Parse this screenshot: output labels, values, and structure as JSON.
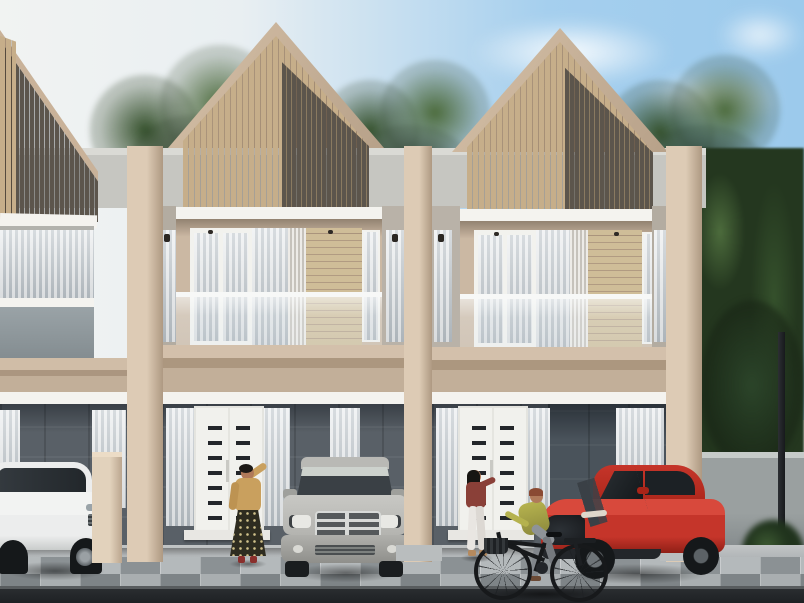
{
  "scene": {
    "type": "architectural-exterior-3d-render",
    "description": "Daytime photorealistic render of a row of modern two-storey minimalist townhouses with gabled facades clad in vertical wood slats (light oak left portion, dark grey-brown right portion), glass-railed balconies with white curtained doors, cream pillars, dark stone ground floors with white slatted entry doors, a checkered paver forecourt, three parked cars, two standing women and a passing cyclist, with dense green trees behind and to the right",
    "weather": "clear day",
    "text_visible": "none"
  },
  "palette": {
    "sky-blue": "#a5cfee",
    "sky-haze": "#f0f3f3",
    "tree-dark": "#24371f",
    "tree-mid": "#35512c",
    "tree-light": "#4c6b3c",
    "wood-light": "#c6ae8a",
    "wood-dark": "#5c554c",
    "plank": "#cfbd98",
    "trim": "#c9b299",
    "fascia-white": "#f4f3ef",
    "wall-cream": "#cbb8a3",
    "wall-cream-light": "#ddcbb5",
    "wall-cream-dark": "#ae9982",
    "parapet-gray": "#c6c6c1",
    "stone-gray": "#596067",
    "stone-dark": "#4a535b",
    "curtain-light": "#e7eaec",
    "curtain-shade": "#b7bfc5",
    "pave-light": "#b4b9bb",
    "pave-mid": "#8b9194",
    "pave-light2": "#a9aeb0",
    "pave-mid2": "#7e8487",
    "road-dark": "#1e2124",
    "boundary-wall": "#9aa0a0",
    "car-white": "#eceded",
    "car-silver": "#b4b4b0",
    "car-red": "#c5352a",
    "car-red-dark": "#8f1f16",
    "stripe-dark": "#3a4046",
    "bike-dark": "#17191b",
    "skin": "#b07a5a",
    "hair-dark": "#1d1a17",
    "outfit-mustard": "#c9a05e",
    "skirt-dark": "#2e2c20",
    "outfit-maroon": "#8a4038",
    "pants-white": "#e9e6e2",
    "outfit-green": "#b5b24e",
    "pants-gray": "#8e9398"
  },
  "buildings": {
    "townhouse_count_fully_visible": 2,
    "neighbor_partial_left": true,
    "storeys": 2,
    "gable": {
      "cladding_left": "light vertical wood slats",
      "cladding_right": "dark grey-brown vertical slats",
      "trim": "cream roof edge"
    },
    "balcony": {
      "railing": "frameless glass with white top rail",
      "elements": [
        "white framed curtained door",
        "sheer curtains",
        "fluted pilaster",
        "horizontal wood plank panel"
      ]
    },
    "ground_floor": {
      "wall": "dark grey stone",
      "entry_door": "white double door with two columns of small dark horizontal slat vents",
      "windows": "full-height with grey sheer curtains",
      "canopy": "thin white horizontal canopy with downlights"
    },
    "dividers": "full-height cream fin pillars between units"
  },
  "vehicles": [
    {
      "name": "white-suv",
      "style": "luxury crossover, three-quarter view facing right",
      "color": "white",
      "position": "far left, behind low cream garden wall"
    },
    {
      "name": "silver-suv",
      "style": "boxy SUV with crosshair chrome grille, front view",
      "color": "silver-grey",
      "position": "in front of left townhouse"
    },
    {
      "name": "red-sports-car",
      "style": "muscle coupe with dark racing stripes, three-quarter view facing left",
      "color": "red",
      "position": "carport of right townhouse"
    }
  ],
  "people": [
    {
      "name": "woman-left",
      "pose": "standing facing viewer, hand raised to head",
      "outfit": "mustard long-sleeve top, dark floral maxi skirt",
      "position": "in front of left entry door"
    },
    {
      "name": "woman-right",
      "pose": "standing at door, back to viewer, arm reaching to door",
      "outfit": "maroon top, white pants",
      "position": "at right entry door"
    },
    {
      "name": "cyclist",
      "pose": "riding city bicycle leftward",
      "outfit": "yellow-green shirt, grey pants",
      "position": "foreground walkway"
    }
  ],
  "environment": {
    "ground": [
      "checkered grey paver tiles",
      "light concrete walkway",
      "dark asphalt road strip at bottom"
    ],
    "right_side": [
      "grey boundary wall",
      "dark street lamp post",
      "low bush",
      "dense trees"
    ],
    "background": "green tree canopies behind roofline, hazy white-to-blue sky with soft clouds"
  }
}
